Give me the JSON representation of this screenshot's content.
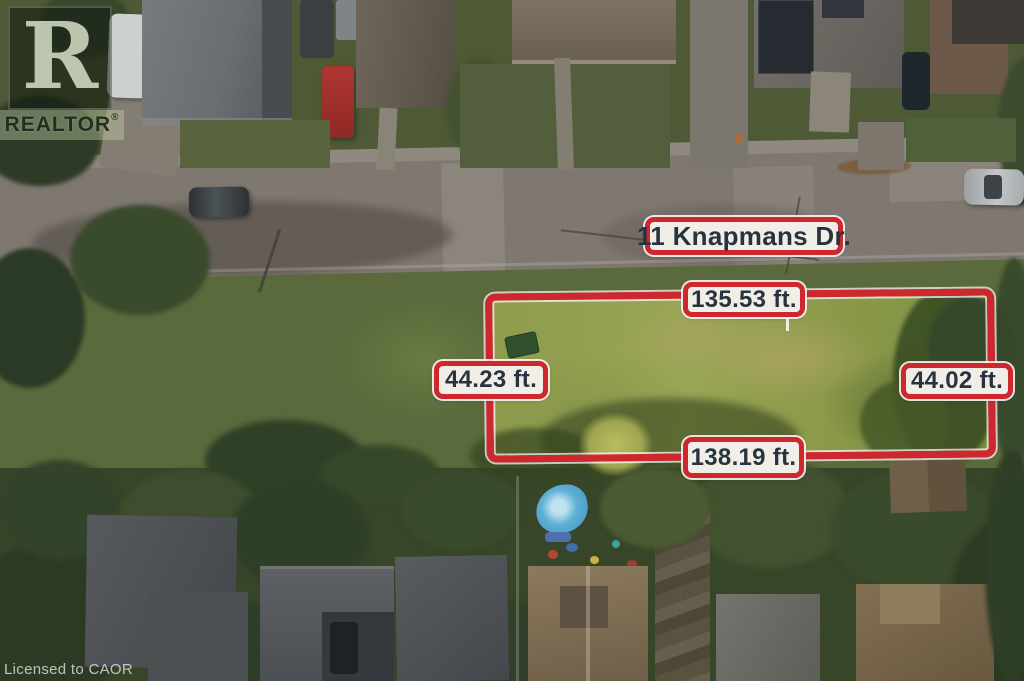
{
  "brand": {
    "logo_letter": "R",
    "name": "REALTOR",
    "registered_mark": "®"
  },
  "license_note": "Licensed to CAOR",
  "listing": {
    "address_label": "11 Knapmans Dr.",
    "boundary": {
      "top_length": "135.53 ft.",
      "left_length": "44.23 ft.",
      "right_length": "44.02 ft.",
      "bottom_length": "138.19 ft."
    }
  },
  "colors": {
    "boundary_red": "#cf272e",
    "label_background": "#f1eee7",
    "label_text": "#27343f"
  }
}
